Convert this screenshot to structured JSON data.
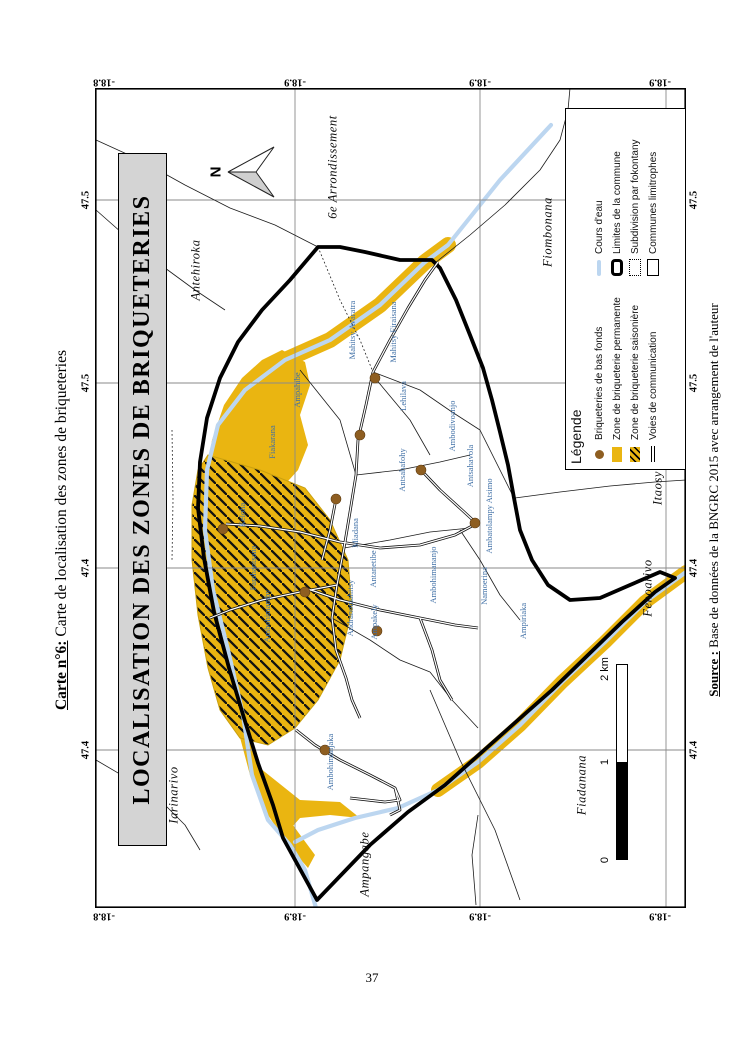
{
  "page": {
    "number": "37"
  },
  "caption": {
    "label": "Carte n°6:",
    "text": " Carte de localisation des zones de briqueteries"
  },
  "source": {
    "label": "Source :",
    "text": " Base de données de la BNGRC 2015 avec arrangement de l'auteur"
  },
  "map": {
    "title": "LOCALISATION DES ZONES DE BRIQUETERIES",
    "north_label": "N",
    "grid": {
      "top": [
        {
          "x": 104,
          "text": "-18.8"
        },
        {
          "x": 295,
          "text": "-18.9"
        },
        {
          "x": 480,
          "text": "-18.9"
        },
        {
          "x": 660,
          "text": "-18.9"
        }
      ],
      "bottom": [
        {
          "x": 104,
          "text": "-18.8"
        },
        {
          "x": 295,
          "text": "-18.9"
        },
        {
          "x": 480,
          "text": "-18.9"
        },
        {
          "x": 660,
          "text": "-18.9"
        }
      ],
      "left": [
        {
          "y": 200,
          "text": "47.5"
        },
        {
          "y": 383,
          "text": "47.5"
        },
        {
          "y": 568,
          "text": "47.4"
        },
        {
          "y": 750,
          "text": "47.4"
        }
      ],
      "right": [
        {
          "y": 200,
          "text": "47.5"
        },
        {
          "y": 383,
          "text": "47.5"
        },
        {
          "y": 568,
          "text": "47.4"
        },
        {
          "y": 750,
          "text": "47.4"
        }
      ]
    },
    "communes": [
      {
        "x": 196,
        "y": 270,
        "text": "Antehiroka"
      },
      {
        "x": 333,
        "y": 167,
        "text": "6e Arrondissement"
      },
      {
        "x": 548,
        "y": 232,
        "text": "Fiombonana"
      },
      {
        "x": 658,
        "y": 488,
        "text": "Itaosy"
      },
      {
        "x": 648,
        "y": 588,
        "text": "Fenoarivo"
      },
      {
        "x": 582,
        "y": 785,
        "text": "Fiadanana"
      },
      {
        "x": 365,
        "y": 864,
        "text": "Ampangabe"
      },
      {
        "x": 174,
        "y": 795,
        "text": "Iarinarivo"
      }
    ],
    "fokontany": [
      {
        "x": 352,
        "y": 330,
        "text": "Mahitsy Avaratra"
      },
      {
        "x": 393,
        "y": 332,
        "text": "Mahitsy Firaisana"
      },
      {
        "x": 297,
        "y": 390,
        "text": "Ampahibe"
      },
      {
        "x": 272,
        "y": 442,
        "text": "Fiakarana"
      },
      {
        "x": 403,
        "y": 396,
        "text": "Lehilava"
      },
      {
        "x": 402,
        "y": 470,
        "text": "Antsahafohy"
      },
      {
        "x": 452,
        "y": 426,
        "text": "Ambodivoanjo"
      },
      {
        "x": 470,
        "y": 466,
        "text": "Antsahavola"
      },
      {
        "x": 242,
        "y": 515,
        "text": "Keloha"
      },
      {
        "x": 253,
        "y": 568,
        "text": "Farahantsana"
      },
      {
        "x": 267,
        "y": 616,
        "text": "Ambohimamby"
      },
      {
        "x": 355,
        "y": 533,
        "text": "Miadana"
      },
      {
        "x": 373,
        "y": 569,
        "text": "Antanetibe"
      },
      {
        "x": 433,
        "y": 575,
        "text": "Ambohimananjo"
      },
      {
        "x": 484,
        "y": 586,
        "text": "Namoerina"
      },
      {
        "x": 489,
        "y": 516,
        "text": "Ambatolampy Atsimo"
      },
      {
        "x": 523,
        "y": 621,
        "text": "Ampiriaka"
      },
      {
        "x": 350,
        "y": 608,
        "text": "Andranomahitsy"
      },
      {
        "x": 374,
        "y": 622,
        "text": "Ampakely"
      },
      {
        "x": 330,
        "y": 762,
        "text": "Ambohimanjaka"
      }
    ],
    "briqueterie_dots": [
      {
        "x": 280,
        "y": 290
      },
      {
        "x": 265,
        "y": 347
      },
      {
        "x": 326,
        "y": 382
      },
      {
        "x": 241,
        "y": 411
      },
      {
        "x": 128,
        "y": 441
      },
      {
        "x": 380,
        "y": 435
      },
      {
        "x": 210,
        "y": 504
      },
      {
        "x": 282,
        "y": 543
      },
      {
        "x": 230,
        "y": 662
      }
    ]
  },
  "legend": {
    "title": "Légende",
    "col1": [
      {
        "symbol": "briqueterie-dot",
        "label": "Briqueteries de bas fonds"
      },
      {
        "symbol": "zone-permanente",
        "label": "Zone de briqueterie permanente"
      },
      {
        "symbol": "zone-saisoniere",
        "label": "Zone de briqueterie saisonière"
      },
      {
        "symbol": "voie-communication",
        "label": "Voies de communication"
      }
    ],
    "col2": [
      {
        "symbol": "cours-eau",
        "label": "Cours d'eau"
      },
      {
        "symbol": "limite-commune",
        "label": "Limites de la commune"
      },
      {
        "symbol": "subdivision-fokontany",
        "label": "Subdivision par fokontany"
      },
      {
        "symbol": "commune-limitrophe",
        "label": "Communes limitrophes"
      }
    ]
  },
  "scalebar": {
    "start": "0",
    "mid": "1",
    "end": "2 km"
  },
  "colors": {
    "zone_yellow": "#EAB511",
    "river_blue": "#BCD6F0",
    "dot_brown": "#8E5E21",
    "label_blue": "#3F6FA6",
    "banner_gray": "#D4D4D4"
  }
}
